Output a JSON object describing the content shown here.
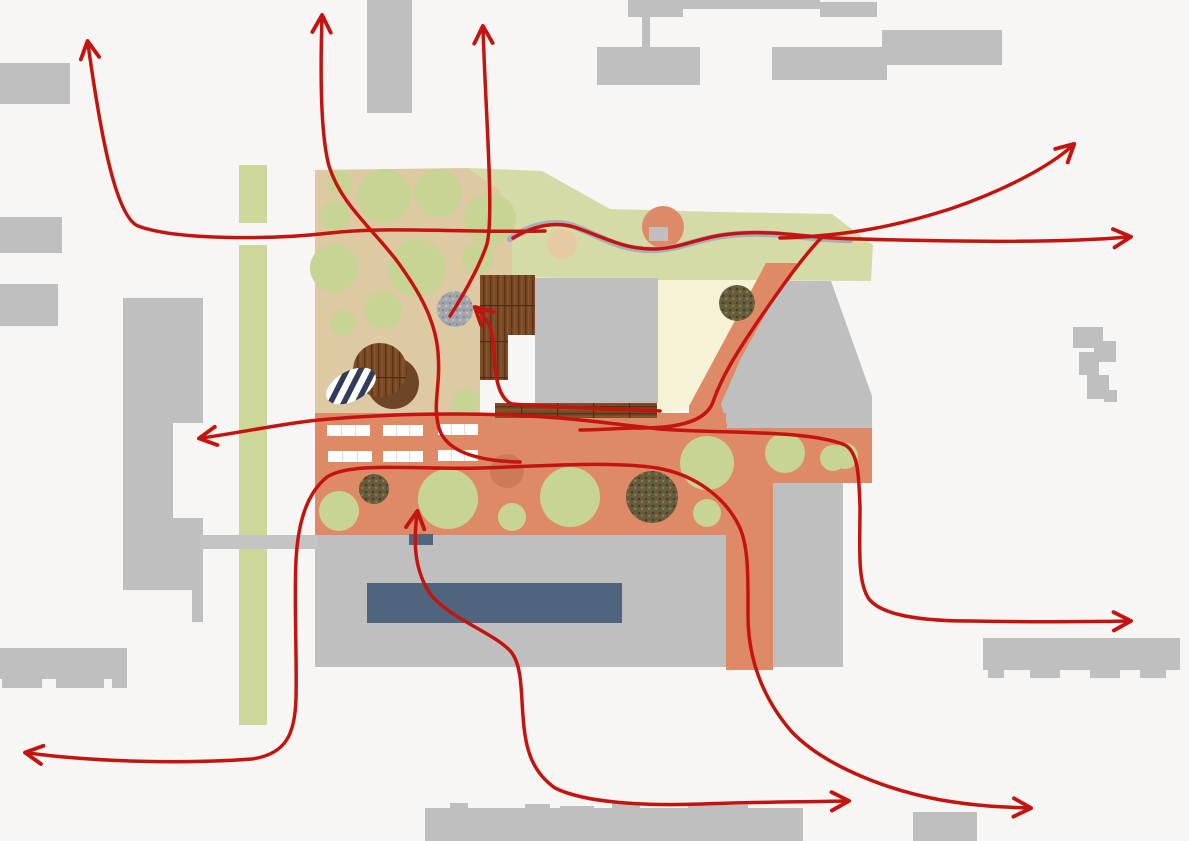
{
  "canvas": {
    "width": 1189,
    "height": 841,
    "background": "#f7f6f4"
  },
  "palette": {
    "background": "#f7f6f4",
    "building": "#bfbfbf",
    "road": "#c4c4c4",
    "green_strip": "#cdd79a",
    "green_area": "#d5dba6",
    "tree": "#c8d494",
    "tan": "#ddc9a2",
    "terracotta": "#df8a66",
    "pale_yellow": "#f5f2d6",
    "orange_circle": "#dd8a68",
    "tan_circle": "#e7c9a3",
    "salmon_circle": "#cd7a57",
    "pool_blue": "#50647e",
    "slate_rect": "#51657f",
    "stream_gray": "#a9aeb6",
    "arrow_red": "#c41410",
    "wood_brown": "#7a4a27",
    "dark_brown": "#6f4527",
    "speckle_base": "#665e3e",
    "gray_circle": "#a3a7ad",
    "stripe_navy": "#323b5a",
    "white": "#ffffff"
  },
  "layers": [
    {
      "name": "context-building",
      "kind": "rect",
      "x": 0,
      "y": 63,
      "w": 70,
      "h": 41,
      "fill": "building"
    },
    {
      "name": "context-building",
      "kind": "rect",
      "x": 0,
      "y": 217,
      "w": 62,
      "h": 36,
      "fill": "building"
    },
    {
      "name": "context-building",
      "kind": "rect",
      "x": 0,
      "y": 284,
      "w": 58,
      "h": 42,
      "fill": "building"
    },
    {
      "name": "context-building",
      "kind": "rect",
      "x": 367,
      "y": 0,
      "w": 45,
      "h": 113,
      "fill": "building"
    },
    {
      "name": "context-building",
      "kind": "rect",
      "x": 628,
      "y": 0,
      "w": 55,
      "h": 17,
      "fill": "building"
    },
    {
      "name": "context-building",
      "kind": "rect",
      "x": 683,
      "y": 0,
      "w": 137,
      "h": 9,
      "fill": "building"
    },
    {
      "name": "context-building",
      "kind": "rect",
      "x": 820,
      "y": 2,
      "w": 57,
      "h": 15,
      "fill": "building"
    },
    {
      "name": "context-building",
      "kind": "rect",
      "x": 642,
      "y": 17,
      "w": 8,
      "h": 31,
      "fill": "building"
    },
    {
      "name": "context-building",
      "kind": "rect",
      "x": 597,
      "y": 47,
      "w": 103,
      "h": 38,
      "fill": "building"
    },
    {
      "name": "context-building",
      "kind": "rect",
      "x": 772,
      "y": 47,
      "w": 115,
      "h": 33,
      "fill": "building"
    },
    {
      "name": "context-building",
      "kind": "rect",
      "x": 882,
      "y": 30,
      "w": 120,
      "h": 35,
      "fill": "building"
    },
    {
      "name": "context-building-l-shaped",
      "kind": "polygon",
      "points": "123,298 203,298 203,423 173,423 173,518 203,518 203,622 192,622 192,590 123,590",
      "fill": "building"
    },
    {
      "name": "context-building",
      "kind": "rect",
      "x": 1073,
      "y": 327,
      "w": 30,
      "h": 21,
      "fill": "building"
    },
    {
      "name": "context-building",
      "kind": "rect",
      "x": 1094,
      "y": 341,
      "w": 22,
      "h": 21,
      "fill": "building"
    },
    {
      "name": "context-building",
      "kind": "rect",
      "x": 1079,
      "y": 352,
      "w": 20,
      "h": 23,
      "fill": "building"
    },
    {
      "name": "context-building",
      "kind": "rect",
      "x": 1087,
      "y": 375,
      "w": 22,
      "h": 24,
      "fill": "building"
    },
    {
      "name": "context-building",
      "kind": "rect",
      "x": 1104,
      "y": 390,
      "w": 13,
      "h": 12,
      "fill": "building"
    },
    {
      "name": "context-building",
      "kind": "rect",
      "x": 0,
      "y": 648,
      "w": 127,
      "h": 31,
      "fill": "building"
    },
    {
      "name": "context-building-tooth",
      "kind": "rect",
      "x": 2,
      "y": 679,
      "w": 40,
      "h": 9,
      "fill": "building"
    },
    {
      "name": "context-building-tooth",
      "kind": "rect",
      "x": 56,
      "y": 679,
      "w": 48,
      "h": 9,
      "fill": "building"
    },
    {
      "name": "context-building-tooth",
      "kind": "rect",
      "x": 112,
      "y": 679,
      "w": 15,
      "h": 9,
      "fill": "building"
    },
    {
      "name": "context-building",
      "kind": "rect",
      "x": 983,
      "y": 638,
      "w": 197,
      "h": 32,
      "fill": "building"
    },
    {
      "name": "context-building-tooth",
      "kind": "rect",
      "x": 988,
      "y": 670,
      "w": 16,
      "h": 8,
      "fill": "building"
    },
    {
      "name": "context-building-tooth",
      "kind": "rect",
      "x": 1030,
      "y": 670,
      "w": 30,
      "h": 8,
      "fill": "building"
    },
    {
      "name": "context-building-tooth",
      "kind": "rect",
      "x": 1090,
      "y": 670,
      "w": 30,
      "h": 8,
      "fill": "building"
    },
    {
      "name": "context-building-tooth",
      "kind": "rect",
      "x": 1140,
      "y": 670,
      "w": 26,
      "h": 8,
      "fill": "building"
    },
    {
      "name": "context-building",
      "kind": "rect",
      "x": 425,
      "y": 808,
      "w": 378,
      "h": 33,
      "fill": "building"
    },
    {
      "name": "context-building-bump",
      "kind": "rect",
      "x": 450,
      "y": 803,
      "w": 18,
      "h": 6,
      "fill": "building"
    },
    {
      "name": "context-building-bump",
      "kind": "rect",
      "x": 525,
      "y": 804,
      "w": 25,
      "h": 5,
      "fill": "building"
    },
    {
      "name": "context-building-bump",
      "kind": "rect",
      "x": 560,
      "y": 806,
      "w": 34,
      "h": 3,
      "fill": "building"
    },
    {
      "name": "context-building-bump",
      "kind": "rect",
      "x": 612,
      "y": 803,
      "w": 28,
      "h": 6,
      "fill": "building"
    },
    {
      "name": "context-building-bump",
      "kind": "rect",
      "x": 688,
      "y": 805,
      "w": 60,
      "h": 4,
      "fill": "building"
    },
    {
      "name": "context-building",
      "kind": "rect",
      "x": 913,
      "y": 812,
      "w": 64,
      "h": 29,
      "fill": "building"
    },
    {
      "name": "green-strip-segment",
      "kind": "rect",
      "x": 239,
      "y": 165,
      "w": 28,
      "h": 58,
      "fill": "green_strip"
    },
    {
      "name": "green-strip-segment",
      "kind": "rect",
      "x": 239,
      "y": 245,
      "w": 28,
      "h": 290,
      "fill": "green_strip"
    },
    {
      "name": "green-strip-segment",
      "kind": "rect",
      "x": 239,
      "y": 549,
      "w": 28,
      "h": 176,
      "fill": "green_strip"
    },
    {
      "name": "site-tan-area",
      "kind": "polygon",
      "points": "315,170 468,168 500,190 512,240 512,277 480,277 480,413 315,413",
      "fill": "tan"
    },
    {
      "name": "site-green-area",
      "kind": "polygon",
      "points": "468,168 542,171 610,209 720,212 832,214 873,245 871,281 658,280 512,277 512,240 500,190",
      "fill": "green_area"
    },
    {
      "name": "site-pale-lawn",
      "kind": "polygon",
      "points": "658,280 770,280 701,405 658,413",
      "fill": "pale_yellow"
    },
    {
      "name": "site-orange-path",
      "kind": "polygon",
      "points": "766,263 797,263 726,430 689,430 689,406",
      "fill": "terracotta"
    },
    {
      "name": "site-gray-wedge-building",
      "kind": "polygon",
      "points": "786,281 831,281 872,396 872,428 728,428 721,404 741,358 760,324 775,297",
      "fill": "building"
    },
    {
      "name": "terracotta-band",
      "kind": "rect",
      "x": 315,
      "y": 413,
      "w": 411,
      "h": 122,
      "fill": "terracotta"
    },
    {
      "name": "terracotta-band",
      "kind": "rect",
      "x": 718,
      "y": 428,
      "w": 154,
      "h": 55,
      "fill": "terracotta"
    },
    {
      "name": "terracotta-band",
      "kind": "rect",
      "x": 726,
      "y": 483,
      "w": 47,
      "h": 49,
      "fill": "terracotta"
    },
    {
      "name": "terracotta-band",
      "kind": "rect",
      "x": 726,
      "y": 532,
      "w": 47,
      "h": 138,
      "fill": "terracotta"
    },
    {
      "name": "plaza",
      "kind": "rect",
      "x": 315,
      "y": 535,
      "w": 411,
      "h": 132,
      "fill": "building"
    },
    {
      "name": "lower-right-building",
      "kind": "rect",
      "x": 773,
      "y": 483,
      "w": 70,
      "h": 184,
      "fill": "building"
    },
    {
      "name": "access-road",
      "kind": "rect",
      "x": 200,
      "y": 535,
      "w": 118,
      "h": 14,
      "fill": "road"
    },
    {
      "name": "tree-circle",
      "kind": "circle",
      "cx": 340,
      "cy": 183,
      "r": 12,
      "fill": "tree"
    },
    {
      "name": "tree-circle",
      "kind": "circle",
      "cx": 384,
      "cy": 196,
      "r": 27,
      "fill": "tree"
    },
    {
      "name": "tree-circle",
      "kind": "circle",
      "cx": 438,
      "cy": 193,
      "r": 24,
      "fill": "tree"
    },
    {
      "name": "tree-circle",
      "kind": "circle",
      "cx": 335,
      "cy": 216,
      "r": 15,
      "fill": "tree"
    },
    {
      "name": "tree-circle",
      "kind": "circle",
      "cx": 334,
      "cy": 268,
      "r": 24,
      "fill": "tree"
    },
    {
      "name": "tree-circle",
      "kind": "circle",
      "cx": 417,
      "cy": 268,
      "r": 29,
      "fill": "tree"
    },
    {
      "name": "tree-circle",
      "kind": "circle",
      "cx": 478,
      "cy": 258,
      "r": 16,
      "fill": "tree"
    },
    {
      "name": "tree-circle",
      "kind": "circle",
      "cx": 490,
      "cy": 219,
      "r": 26,
      "fill": "tree"
    },
    {
      "name": "tree-circle",
      "kind": "circle",
      "cx": 343,
      "cy": 323,
      "r": 13,
      "fill": "tree"
    },
    {
      "name": "tree-circle",
      "kind": "circle",
      "cx": 383,
      "cy": 310,
      "r": 19,
      "fill": "tree"
    },
    {
      "name": "tree-circle",
      "kind": "circle",
      "cx": 466,
      "cy": 402,
      "r": 14,
      "fill": "tree"
    },
    {
      "name": "tan-circle",
      "kind": "circle",
      "cx": 562,
      "cy": 244,
      "r": 15,
      "fill": "tan_circle"
    },
    {
      "name": "orange-circle",
      "kind": "circle",
      "cx": 663,
      "cy": 227,
      "r": 21,
      "fill": "orange_circle"
    },
    {
      "name": "orange-circle-platform",
      "kind": "rect",
      "x": 649,
      "y": 227,
      "w": 19,
      "h": 14,
      "fill": "building"
    },
    {
      "name": "stream",
      "kind": "path",
      "d": "M510,239 C532,224 556,219 576,227 C604,238 622,251 656,250 C686,248 700,236 742,234 C782,232 802,239 850,240",
      "stroke": "stream_gray",
      "width": 6.5
    },
    {
      "name": "planting-circle-dark",
      "kind": "circle",
      "cx": 737,
      "cy": 303,
      "r": 18,
      "fill": "pattern:speckle-dark"
    },
    {
      "name": "gravel-circle",
      "kind": "circle",
      "cx": 455,
      "cy": 309,
      "r": 18,
      "fill": "pattern:speckle-gray"
    },
    {
      "name": "brown-circle",
      "kind": "circle",
      "cx": 393,
      "cy": 383,
      "r": 26,
      "fill": "dark_brown"
    },
    {
      "name": "wood-deck-circle",
      "kind": "circle",
      "cx": 380,
      "cy": 370,
      "r": 27,
      "fill": "pattern:wood"
    },
    {
      "name": "striped-ellipse",
      "kind": "ellipse",
      "cx": 351,
      "cy": 386,
      "rx": 27,
      "ry": 15,
      "rot": -28,
      "fill": "pattern:stripes"
    },
    {
      "name": "wood-deck",
      "kind": "rect",
      "x": 480,
      "y": 275,
      "w": 55,
      "h": 60,
      "fill": "pattern:wood"
    },
    {
      "name": "wood-deck",
      "kind": "rect",
      "x": 480,
      "y": 335,
      "w": 28,
      "h": 45,
      "fill": "pattern:wood"
    },
    {
      "name": "wood-deck",
      "kind": "rect",
      "x": 495,
      "y": 403,
      "w": 162,
      "h": 15,
      "fill": "pattern:wood-h"
    },
    {
      "name": "main-building",
      "kind": "rect",
      "x": 535,
      "y": 278,
      "w": 123,
      "h": 125,
      "fill": "building"
    },
    {
      "name": "parking-strip",
      "kind": "parking",
      "x": 327,
      "y": 425,
      "w": 43,
      "h": 11,
      "stalls": 3
    },
    {
      "name": "parking-strip",
      "kind": "parking",
      "x": 383,
      "y": 425,
      "w": 40,
      "h": 11,
      "stalls": 3
    },
    {
      "name": "parking-strip",
      "kind": "parking",
      "x": 438,
      "y": 424,
      "w": 40,
      "h": 11,
      "stalls": 3
    },
    {
      "name": "parking-strip",
      "kind": "parking",
      "x": 328,
      "y": 451,
      "w": 44,
      "h": 11,
      "stalls": 3
    },
    {
      "name": "parking-strip",
      "kind": "parking",
      "x": 383,
      "y": 451,
      "w": 40,
      "h": 11,
      "stalls": 3
    },
    {
      "name": "parking-strip",
      "kind": "parking",
      "x": 438,
      "y": 450,
      "w": 40,
      "h": 11,
      "stalls": 3
    },
    {
      "name": "planting-circle-dark",
      "kind": "circle",
      "cx": 374,
      "cy": 489,
      "r": 15,
      "fill": "pattern:speckle-dark"
    },
    {
      "name": "tree-circle",
      "kind": "circle",
      "cx": 339,
      "cy": 511,
      "r": 20,
      "fill": "tree"
    },
    {
      "name": "tree-circle",
      "kind": "circle",
      "cx": 448,
      "cy": 499,
      "r": 30,
      "fill": "tree"
    },
    {
      "name": "salmon-circle",
      "kind": "circle",
      "cx": 507,
      "cy": 471,
      "r": 17,
      "fill": "salmon_circle"
    },
    {
      "name": "tree-circle",
      "kind": "circle",
      "cx": 512,
      "cy": 517,
      "r": 14,
      "fill": "tree"
    },
    {
      "name": "tree-circle",
      "kind": "circle",
      "cx": 570,
      "cy": 497,
      "r": 30,
      "fill": "tree"
    },
    {
      "name": "planting-circle-dark",
      "kind": "circle",
      "cx": 652,
      "cy": 497,
      "r": 26,
      "fill": "pattern:speckle-dark"
    },
    {
      "name": "tree-circle",
      "kind": "circle",
      "cx": 707,
      "cy": 463,
      "r": 27,
      "fill": "tree"
    },
    {
      "name": "tree-circle",
      "kind": "circle",
      "cx": 785,
      "cy": 453,
      "r": 20,
      "fill": "tree"
    },
    {
      "name": "tree-circle",
      "kind": "circle",
      "cx": 833,
      "cy": 458,
      "r": 13,
      "fill": "tree"
    },
    {
      "name": "tree-circle",
      "kind": "circle",
      "cx": 707,
      "cy": 513,
      "r": 14,
      "fill": "tree"
    },
    {
      "name": "tree-circle",
      "kind": "circle",
      "cx": 845,
      "cy": 456,
      "r": 13,
      "fill": "tree"
    },
    {
      "name": "pool",
      "kind": "rect",
      "x": 367,
      "y": 583,
      "w": 255,
      "h": 40,
      "fill": "pool_blue"
    },
    {
      "name": "slate-platform",
      "kind": "rect",
      "x": 409,
      "y": 534,
      "w": 24,
      "h": 11,
      "fill": "slate_rect"
    },
    {
      "name": "flow-arrow-northwest",
      "kind": "arrow",
      "d": "M545,231 C470,233 390,226 330,233 C270,240 175,240 138,226 C115,216 100,130 88,44",
      "heads": "end"
    },
    {
      "name": "flow-arrow-north-left",
      "kind": "arrow",
      "d": "M520,462 C478,461 446,452 439,428 C432,402 441,388 438,352 C435,318 418,290 397,261 C370,226 341,204 329,166 C321,136 320,80 322,18",
      "heads": "end"
    },
    {
      "name": "flow-arrow-north-center",
      "kind": "arrow",
      "d": "M450,316 C462,297 479,268 487,244 C494,215 486,120 483,29",
      "heads": "end"
    },
    {
      "name": "flow-arrow-northeast",
      "kind": "arrow",
      "d": "M780,238 C850,236 900,225 950,209 C1000,192 1048,168 1072,146",
      "heads": "end"
    },
    {
      "name": "flow-arrow-east-stream",
      "kind": "arrow",
      "d": "M513,238 C533,226 553,221 574,227 C602,236 623,250 657,249 C688,247 701,235 743,233 C783,231 803,238 860,239 C960,242 1060,243 1128,237",
      "heads": "end"
    },
    {
      "name": "flow-arrow-west-east",
      "kind": "arrow",
      "d": "M202,438 C250,431 290,422 330,419 C390,414 450,413 510,415 C580,418 620,425 660,429 C720,434 805,429 845,445 C858,452 859,475 860,508 C860,545 857,582 869,599 C883,617 930,621 970,621 C1030,622 1080,622 1128,621",
      "heads": "both"
    },
    {
      "name": "flow-arrow-to-gravel",
      "kind": "arrow",
      "d": "M660,411 C610,409 545,407 512,404 C499,399 495,378 494,354 C494,333 490,321 477,309",
      "heads": "end"
    },
    {
      "name": "flow-arrow-plaza",
      "kind": "arrow",
      "d": "M417,514 C413,545 415,572 431,595 C452,620 497,634 512,653 C522,667 521,692 523,716 C525,747 531,771 555,788 C585,803 645,806 702,804 C755,802 800,802 846,801",
      "heads": "both"
    },
    {
      "name": "flow-arrow-southwest-southeast",
      "kind": "arrow",
      "d": "M28,753 C95,762 185,764 252,759 C287,754 295,733 296,698 C297,658 294,600 296,560 C298,524 306,494 327,477 C352,461 420,470 480,468 C545,466 612,461 657,468 C697,475 726,499 739,526 C749,546 748,580 748,616 C748,656 761,696 791,731 C822,764 882,789 941,800 C976,806 1000,807 1028,808",
      "heads": "both"
    },
    {
      "name": "flow-line-orange-path",
      "kind": "arrow",
      "d": "M822,237 C801,259 780,289 756,324 C736,354 722,376 713,402 C706,421 680,428 642,428 C620,428 600,430 580,430",
      "heads": "none"
    }
  ]
}
